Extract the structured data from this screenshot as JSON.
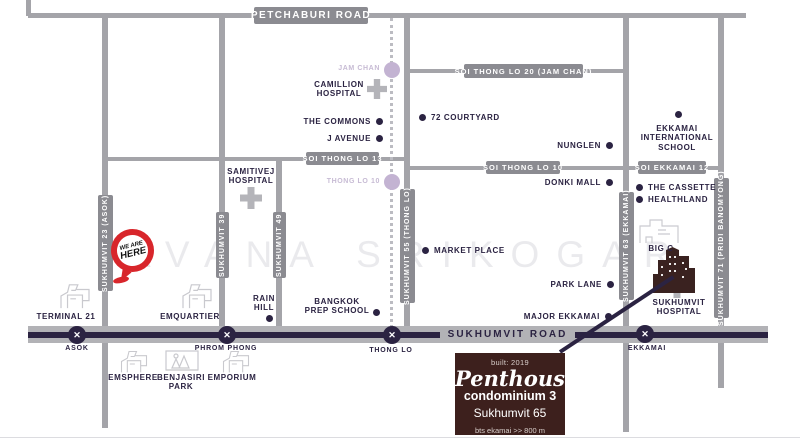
{
  "colors": {
    "ink_navy": "#2b2342",
    "road_gray": "#a4a4a9",
    "road_label_gray": "#8b8b91",
    "main_road_gray": "#b2b2b6",
    "grey_line_purple": "#c3b3d2",
    "marker_red": "#d8262b",
    "info_box_maroon": "#3d201d"
  },
  "watermark": "AVANA SRIKOGAR",
  "roads": {
    "petchaburi": "PETCHABURI ROAD",
    "soi_thong_lo_20": "SOI THONG LO 20 (JAM CHAN)",
    "soi_thong_lo_13": "SOI THONG LO 13",
    "soi_thong_lo_10": "SOI THONG LO 10",
    "soi_ekkamai_12": "SOI EKKAMAI 12",
    "sukhumvit_23": "SUKHUMVIT 23 (ASOK)",
    "sukhumvit_39": "SUKHUMVIT 39",
    "sukhumvit_49": "SUKHUMVIT 49",
    "sukhumvit_55": "SUKHUMVIT 55 (THONG LO)",
    "sukhumvit_63": "SUKHUMVIT 63 (EKKAMAI)",
    "sukhumvit_71": "SUKHUMVIT 71 (PRIDI BANOMYONG)",
    "sukhumvit_road": "SUKHUMVIT ROAD"
  },
  "stations": {
    "bts": {
      "asok": "ASOK",
      "phrom_phong": "PHROM PHONG",
      "thong_lo": "THONG LO",
      "ekkamai": "EKKAMAI"
    },
    "grey_line": {
      "jam_chan": "JAM CHAN",
      "thong_lo_10": "THONG LO 10"
    }
  },
  "landmarks": {
    "camillion_hospital": "CAMILLION\nHOSPITAL",
    "samitivej_hospital": "SAMITIVEJ\nHOSPITAL",
    "sukhumvit_hospital": "SUKHUMVIT\nHOSPITAL",
    "the_commons": "THE COMMONS",
    "j_avenue": "J AVENUE",
    "courtyard_72": "72 COURTYARD",
    "nunglen": "NUNGLEN",
    "ekkamai_international_school": "EKKAMAI\nINTERNATIONAL\nSCHOOL",
    "donki_mall": "DONKI MALL",
    "the_cassette": "THE CASSETTE",
    "healthland": "HEALTHLAND",
    "market_place": "MARKET PLACE",
    "park_lane": "PARK LANE",
    "major_ekkamai": "MAJOR EKKAMAI",
    "big_c": "BIG C",
    "rain_hill": "RAIN\nHILL",
    "bangkok_prep_school": "BANGKOK\nPREP SCHOOL",
    "terminal_21": "TERMINAL 21",
    "emquartier": "EMQUARTIER",
    "emsphere": "EMSPHERE",
    "benjasiri_park": "BENJASIRI\nPARK",
    "emporium": "EMPORIUM"
  },
  "marker": {
    "line1": "WE ARE",
    "line2": "HERE"
  },
  "info_box": {
    "built": "built: 2019",
    "name": "Penthouse",
    "type": "condominium 3",
    "address": "Sukhumvit 65",
    "bts_distance": "bts ekamai >> 800 m"
  }
}
